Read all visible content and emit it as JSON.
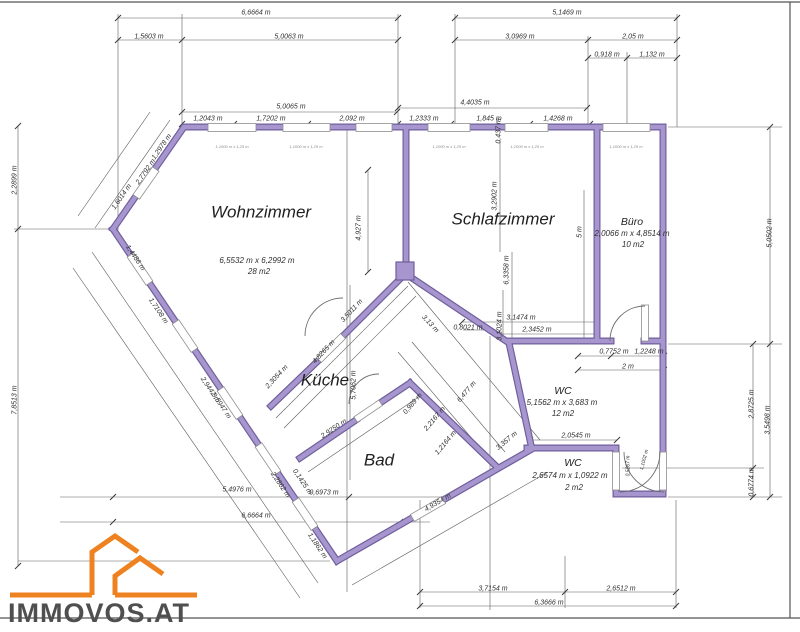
{
  "logo": {
    "text": "IMMOVOS.AT"
  },
  "colors": {
    "wall_fill": "#a795ce",
    "wall_edge": "#6f5f9d",
    "dimension_line": "#4a4a4a",
    "logo_orange": "#ee8220",
    "logo_text": "#4f4f4f"
  },
  "rooms": [
    {
      "name": "wohnzimmer",
      "label": "Wohnzimmer",
      "size": "6,5532 m x 6,2992 m",
      "area": "28 m2"
    },
    {
      "name": "schlafzimmer",
      "label": "Schlafzimmer",
      "size": "",
      "area": ""
    },
    {
      "name": "buero",
      "label": "Büro",
      "size": "2,0066 m x 4,8514 m",
      "area": "10 m2"
    },
    {
      "name": "kueche",
      "label": "Küche",
      "size": "",
      "area": ""
    },
    {
      "name": "bad",
      "label": "Bad",
      "size": "",
      "area": ""
    },
    {
      "name": "wc",
      "label": "WC",
      "size": "5,1562 m x 3,683 m",
      "area": "12 m2"
    },
    {
      "name": "wc2",
      "label": "WC",
      "size": "2,6574 m x 1,0922 m",
      "area": "2 m2"
    }
  ],
  "labels": [
    {
      "t": "6,6664 m",
      "x": 256,
      "y": 13
    },
    {
      "t": "1,5603 m",
      "x": 149,
      "y": 37
    },
    {
      "t": "5,0063 m",
      "x": 289,
      "y": 37
    },
    {
      "t": "5,1469 m",
      "x": 567,
      "y": 13
    },
    {
      "t": "3,0969 m",
      "x": 520,
      "y": 37
    },
    {
      "t": "2,05 m",
      "x": 633,
      "y": 37
    },
    {
      "t": "0,918 m",
      "x": 607,
      "y": 55
    },
    {
      "t": "1,132 m",
      "x": 652,
      "y": 55
    },
    {
      "t": "5,0065 m",
      "x": 291,
      "y": 107
    },
    {
      "t": "1,2043 m",
      "x": 208,
      "y": 119
    },
    {
      "t": "1,7202 m",
      "x": 271,
      "y": 119
    },
    {
      "t": "2,092 m",
      "x": 352,
      "y": 119
    },
    {
      "t": "1,2333 m",
      "x": 424,
      "y": 119
    },
    {
      "t": "4,4035 m",
      "x": 475,
      "y": 103
    },
    {
      "t": "1,845 m",
      "x": 489,
      "y": 119
    },
    {
      "t": "0,437 m",
      "x": 499,
      "y": 131,
      "r": -90
    },
    {
      "t": "1,4268 m",
      "x": 558,
      "y": 119
    },
    {
      "t": "2,2899 m",
      "x": 15,
      "y": 180,
      "r": -90
    },
    {
      "t": "7,8513 m",
      "x": 15,
      "y": 400,
      "r": -90
    },
    {
      "t": "1,2978 m",
      "x": 162,
      "y": 147,
      "r": -55
    },
    {
      "t": "2,7792 m",
      "x": 146,
      "y": 172,
      "r": -55
    },
    {
      "t": "1,6014 m",
      "x": 122,
      "y": 197,
      "r": -55
    },
    {
      "t": "1,4486 m",
      "x": 135,
      "y": 258,
      "r": 56
    },
    {
      "t": "1,7108 m",
      "x": 158,
      "y": 311,
      "r": 56
    },
    {
      "t": "2,9442 m",
      "x": 210,
      "y": 390,
      "r": 56
    },
    {
      "t": "9,5947 m",
      "x": 221,
      "y": 406,
      "r": 56
    },
    {
      "t": "5,4976 m",
      "x": 237,
      "y": 490
    },
    {
      "t": "6,6664 m",
      "x": 256,
      "y": 516
    },
    {
      "t": "2,2862 m",
      "x": 280,
      "y": 485,
      "r": 56
    },
    {
      "t": "0,1425 m",
      "x": 302,
      "y": 482,
      "r": 56
    },
    {
      "t": "0,6973 m",
      "x": 324,
      "y": 493
    },
    {
      "t": "1,1862 m",
      "x": 317,
      "y": 546,
      "r": 56
    },
    {
      "t": "4,9354 m",
      "x": 438,
      "y": 503,
      "r": -30
    },
    {
      "t": "3,7154 m",
      "x": 493,
      "y": 589
    },
    {
      "t": "2,6512 m",
      "x": 621,
      "y": 589
    },
    {
      "t": "6,3666 m",
      "x": 549,
      "y": 603
    },
    {
      "t": "5,0502 m",
      "x": 770,
      "y": 233,
      "r": -90
    },
    {
      "t": "2,8725 m",
      "x": 752,
      "y": 404,
      "r": -90
    },
    {
      "t": "3,5498 m",
      "x": 768,
      "y": 420,
      "r": -90
    },
    {
      "t": "0,6774 m",
      "x": 752,
      "y": 482,
      "r": -90
    },
    {
      "t": "4,927 m",
      "x": 359,
      "y": 228,
      "r": -90
    },
    {
      "t": "3,2902 m",
      "x": 495,
      "y": 196,
      "r": -90
    },
    {
      "t": "6,3358 m",
      "x": 507,
      "y": 270,
      "r": -90
    },
    {
      "t": "5 m",
      "x": 580,
      "y": 232,
      "r": -90
    },
    {
      "t": "3,1474 m",
      "x": 521,
      "y": 318
    },
    {
      "t": "2,3452 m",
      "x": 537,
      "y": 330
    },
    {
      "t": "0,8021 m",
      "x": 468,
      "y": 328
    },
    {
      "t": "3,1024 m",
      "x": 500,
      "y": 326,
      "r": -90
    },
    {
      "t": "0,7752 m",
      "x": 614,
      "y": 352
    },
    {
      "t": "1,2248 m",
      "x": 649,
      "y": 352
    },
    {
      "t": "2 m",
      "x": 628,
      "y": 367
    },
    {
      "t": "2,0545 m",
      "x": 576,
      "y": 436
    },
    {
      "t": "2,3054 m",
      "x": 277,
      "y": 377,
      "r": -47
    },
    {
      "t": "4,8265 m",
      "x": 324,
      "y": 352,
      "r": -47
    },
    {
      "t": "3,5011 m",
      "x": 352,
      "y": 311,
      "r": -47
    },
    {
      "t": "3,13 m",
      "x": 430,
      "y": 324,
      "r": 47
    },
    {
      "t": "5,7062 m",
      "x": 354,
      "y": 385,
      "r": -90
    },
    {
      "t": "2,9250 m",
      "x": 334,
      "y": 429,
      "r": -34
    },
    {
      "t": "0,989 m",
      "x": 413,
      "y": 404,
      "r": -50
    },
    {
      "t": "2,2167 m",
      "x": 435,
      "y": 419,
      "r": -50
    },
    {
      "t": "1,2164 m",
      "x": 446,
      "y": 443,
      "r": -50
    },
    {
      "t": "6,477 m",
      "x": 467,
      "y": 392,
      "r": -50
    },
    {
      "t": "3,357 m",
      "x": 507,
      "y": 441,
      "r": -40
    },
    {
      "t": "0,5267 m",
      "x": 629,
      "y": 466,
      "r": -90,
      "c": "tiny2"
    },
    {
      "t": "1,1002 m",
      "x": 645,
      "y": 460,
      "r": -75,
      "c": "tiny2"
    },
    {
      "t": "Wohnzimmer",
      "x": 261,
      "y": 212,
      "c": "room-lg",
      "n": "room-label-wohnzimmer"
    },
    {
      "t": "6,5532 m x 6,2992 m",
      "x": 257,
      "y": 261,
      "c": "sub",
      "n": "room-size-wohnzimmer"
    },
    {
      "t": "28 m2",
      "x": 259,
      "y": 272,
      "c": "sub",
      "n": "room-area-wohnzimmer"
    },
    {
      "t": "Schlafzimmer",
      "x": 503,
      "y": 219,
      "c": "room-lg",
      "n": "room-label-schlafzimmer"
    },
    {
      "t": "Büro",
      "x": 632,
      "y": 222,
      "c": "room-md",
      "n": "room-label-buero"
    },
    {
      "t": "2,0066 m x 4,8514 m",
      "x": 632,
      "y": 234,
      "c": "sub",
      "n": "room-size-buero"
    },
    {
      "t": "10 m2",
      "x": 633,
      "y": 245,
      "c": "sub",
      "n": "room-area-buero"
    },
    {
      "t": "Küche",
      "x": 325,
      "y": 380,
      "c": "room-lg",
      "n": "room-label-kueche"
    },
    {
      "t": "Bad",
      "x": 379,
      "y": 460,
      "c": "room-lg",
      "n": "room-label-bad"
    },
    {
      "t": "WC",
      "x": 563,
      "y": 391,
      "c": "room-md",
      "n": "room-label-wc"
    },
    {
      "t": "5,1562 m x 3,683 m",
      "x": 562,
      "y": 403,
      "c": "sub",
      "n": "room-size-wc"
    },
    {
      "t": "12 m2",
      "x": 563,
      "y": 414,
      "c": "sub",
      "n": "room-area-wc"
    },
    {
      "t": "WC",
      "x": 573,
      "y": 463,
      "c": "room-md",
      "n": "room-label-wc2"
    },
    {
      "t": "2,6574 m x 1,0922 m",
      "x": 570,
      "y": 476,
      "c": "sub",
      "n": "room-size-wc2"
    },
    {
      "t": "2 m2",
      "x": 574,
      "y": 488,
      "c": "sub",
      "n": "room-area-wc2"
    },
    {
      "t": "1,1000 m x 1,25 m",
      "x": 232,
      "y": 147,
      "c": "tiny"
    },
    {
      "t": "1,1000 m x 1,25 m",
      "x": 306,
      "y": 147,
      "c": "tiny"
    },
    {
      "t": "1,1000 m x 1,25 m",
      "x": 449,
      "y": 147,
      "c": "tiny"
    },
    {
      "t": "1,1000 m x 1,25 m",
      "x": 527,
      "y": 147,
      "c": "tiny"
    },
    {
      "t": "1,1000 m x 1,25 m",
      "x": 626,
      "y": 147,
      "c": "tiny"
    }
  ]
}
